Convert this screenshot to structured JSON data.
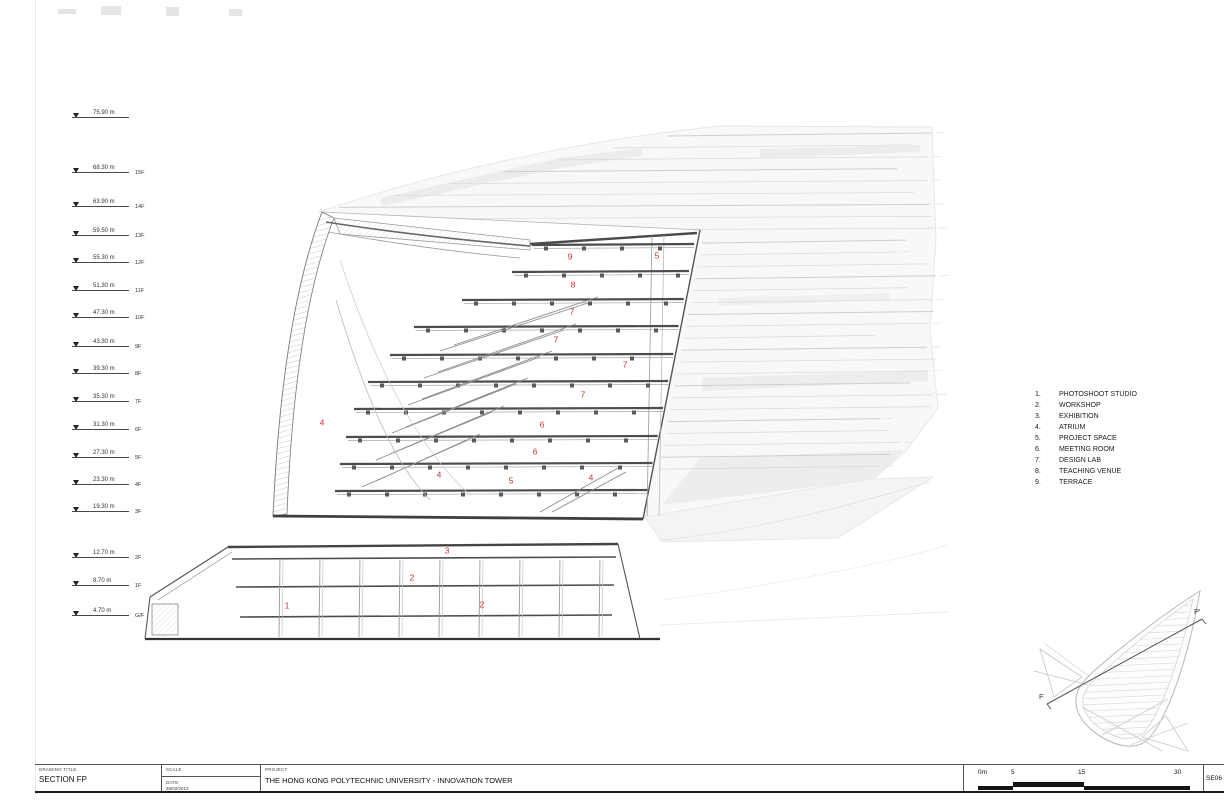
{
  "title_block": {
    "drawing_title_label": "DRAWING TITLE",
    "drawing_title": "SECTION FP",
    "scale_label": "SCALE",
    "date_label": "DATE",
    "date_value": "26/02/2013",
    "project_label": "PROJECT",
    "project_name": "THE HONG KONG POLYTECHNIC UNIVERSITY - INNOVATION TOWER",
    "sheet_number": "SE06"
  },
  "scale_bar": {
    "unit_labels": [
      "0m",
      "5",
      "15",
      "30"
    ]
  },
  "levels": [
    {
      "elevation": "75.90 m",
      "floor": "",
      "y": 118
    },
    {
      "elevation": "68.30 m",
      "floor": "15F",
      "y": 173
    },
    {
      "elevation": "63.90 m",
      "floor": "14F",
      "y": 207
    },
    {
      "elevation": "59.50 m",
      "floor": "13F",
      "y": 236
    },
    {
      "elevation": "55.30 m",
      "floor": "12F",
      "y": 263
    },
    {
      "elevation": "51.30 m",
      "floor": "11F",
      "y": 291
    },
    {
      "elevation": "47.30 m",
      "floor": "10F",
      "y": 318
    },
    {
      "elevation": "43.30 m",
      "floor": "9F",
      "y": 347
    },
    {
      "elevation": "39.30 m",
      "floor": "8F",
      "y": 374
    },
    {
      "elevation": "35.30 m",
      "floor": "7F",
      "y": 402
    },
    {
      "elevation": "31.30 m",
      "floor": "6F",
      "y": 430
    },
    {
      "elevation": "27.30 m",
      "floor": "5F",
      "y": 458
    },
    {
      "elevation": "23.30 m",
      "floor": "4F",
      "y": 485
    },
    {
      "elevation": "19.30 m",
      "floor": "3F",
      "y": 512
    },
    {
      "elevation": "12.70 m",
      "floor": "2F",
      "y": 558
    },
    {
      "elevation": "8.70 m",
      "floor": "1F",
      "y": 586
    },
    {
      "elevation": "4.70 m",
      "floor": "G/F",
      "y": 616
    }
  ],
  "legend": {
    "items": [
      {
        "num": "1.",
        "label": "PHOTOSHOOT STUDIO"
      },
      {
        "num": "2.",
        "label": "WORKSHOP"
      },
      {
        "num": "3.",
        "label": "EXHIBITION"
      },
      {
        "num": "4.",
        "label": "ATRIUM"
      },
      {
        "num": "5.",
        "label": "PROJECT SPACE"
      },
      {
        "num": "6.",
        "label": "MEETING ROOM"
      },
      {
        "num": "7.",
        "label": "DESIGN LAB"
      },
      {
        "num": "8.",
        "label": "TEACHING VENUE"
      },
      {
        "num": "9.",
        "label": "TERRACE"
      }
    ]
  },
  "section_labels": [
    {
      "t": "9",
      "x": 570,
      "y": 257
    },
    {
      "t": "5",
      "x": 657,
      "y": 256
    },
    {
      "t": "8",
      "x": 573,
      "y": 285
    },
    {
      "t": "7",
      "x": 572,
      "y": 312
    },
    {
      "t": "7",
      "x": 556,
      "y": 340
    },
    {
      "t": "7",
      "x": 625,
      "y": 365
    },
    {
      "t": "7",
      "x": 583,
      "y": 395
    },
    {
      "t": "4",
      "x": 322,
      "y": 423
    },
    {
      "t": "6",
      "x": 542,
      "y": 425
    },
    {
      "t": "6",
      "x": 535,
      "y": 452
    },
    {
      "t": "4",
      "x": 439,
      "y": 475
    },
    {
      "t": "5",
      "x": 511,
      "y": 481
    },
    {
      "t": "4",
      "x": 591,
      "y": 478
    },
    {
      "t": "3",
      "x": 447,
      "y": 551
    },
    {
      "t": "2",
      "x": 412,
      "y": 578
    },
    {
      "t": "1",
      "x": 287,
      "y": 606
    },
    {
      "t": "2",
      "x": 482,
      "y": 605
    }
  ],
  "key_plan": {
    "start_label": "F",
    "end_label": "P'"
  },
  "colors": {
    "label_red": "#cc3333",
    "line_dark": "#4a4a4a",
    "line_light": "#dcdcdc"
  }
}
